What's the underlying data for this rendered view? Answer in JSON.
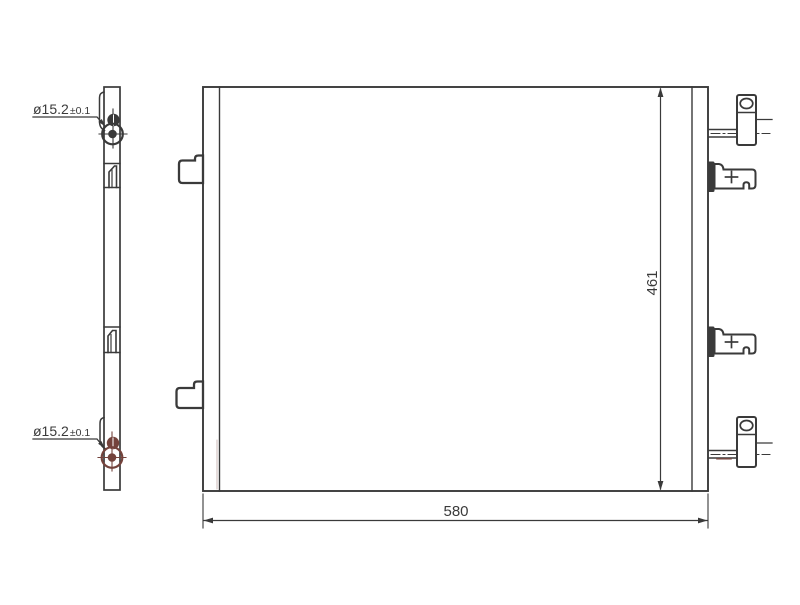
{
  "colors": {
    "line": "#3a3a3a",
    "accent": "#74433c",
    "background": "#ffffff"
  },
  "drawing": {
    "callouts": {
      "top_port": {
        "diameter": "ø15.2",
        "tolerance": "±0.1"
      },
      "bottom_port": {
        "diameter": "ø15.2",
        "tolerance": "±0.1"
      }
    },
    "dimensions": {
      "overall_width": "580",
      "overall_height": "461"
    }
  }
}
